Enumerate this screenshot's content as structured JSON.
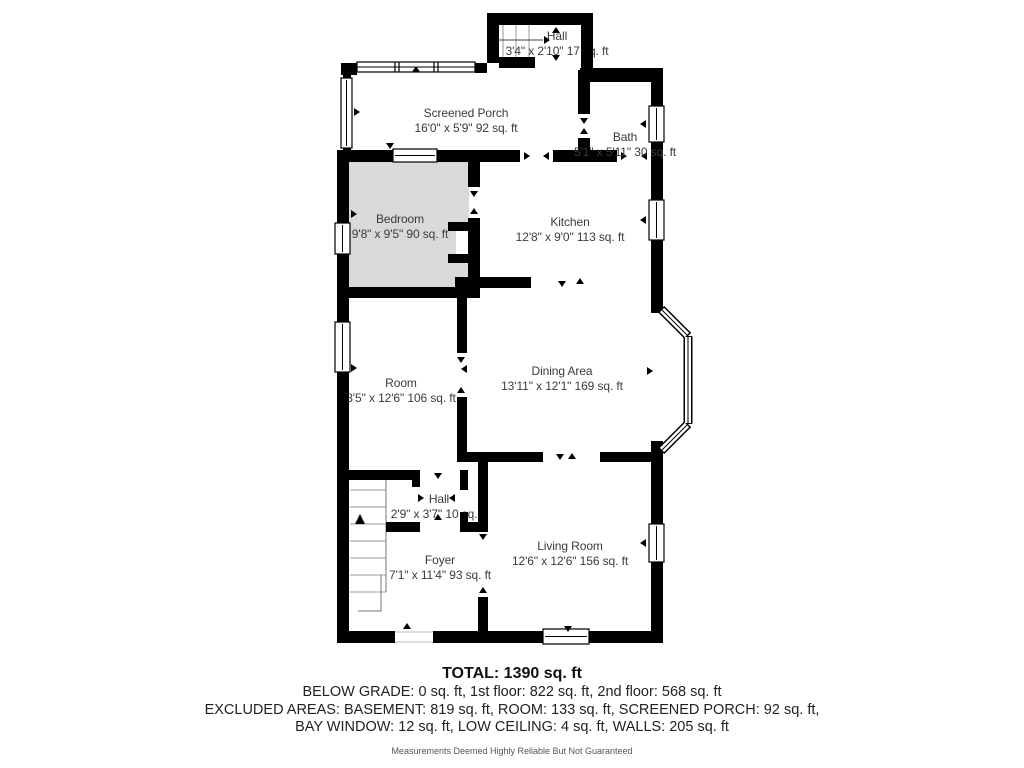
{
  "floor_plan": {
    "rooms": [
      {
        "id": "hall-upper",
        "name": "Hall",
        "dims": "3'4\" x 2'10\" 17 sq. ft"
      },
      {
        "id": "screened-porch",
        "name": "Screened Porch",
        "dims": "16'0\" x 5'9\" 92 sq. ft"
      },
      {
        "id": "bath",
        "name": "Bath",
        "dims": "5'1\" x 5'11\" 30 sq. ft"
      },
      {
        "id": "bedroom",
        "name": "Bedroom",
        "dims": "9'8\" x 9'5\" 90 sq. ft"
      },
      {
        "id": "kitchen",
        "name": "Kitchen",
        "dims": "12'8\" x 9'0\" 113 sq. ft"
      },
      {
        "id": "dining-area",
        "name": "Dining Area",
        "dims": "13'11\" x 12'1\" 169 sq. ft"
      },
      {
        "id": "room",
        "name": "Room",
        "dims": "8'5\" x 12'6\" 106 sq. ft"
      },
      {
        "id": "hall-lower",
        "name": "Hall",
        "dims": "2'9\" x 3'7\" 10 sq. ft"
      },
      {
        "id": "foyer",
        "name": "Foyer",
        "dims": "7'1\" x 11'4\" 93 sq. ft"
      },
      {
        "id": "living-room",
        "name": "Living Room",
        "dims": "12'6\" x 12'6\" 156 sq. ft"
      }
    ],
    "colors": {
      "wall": "#000000",
      "low_ceiling_fill": "#d9d9d9",
      "label_text": "#3b3b3b"
    }
  },
  "summary": {
    "total": "TOTAL: 1390 sq. ft",
    "floors_line": "BELOW GRADE: 0 sq. ft, 1st floor: 822 sq. ft, 2nd floor: 568 sq. ft",
    "excluded_line1": "EXCLUDED AREAS: BASEMENT: 819 sq. ft, ROOM: 133 sq. ft, SCREENED PORCH: 92 sq. ft,",
    "excluded_line2": "BAY WINDOW: 12 sq. ft, LOW CEILING: 4 sq. ft, WALLS: 205 sq. ft",
    "disclaimer": "Measurements Deemed Highly Reliable But Not Guaranteed"
  }
}
